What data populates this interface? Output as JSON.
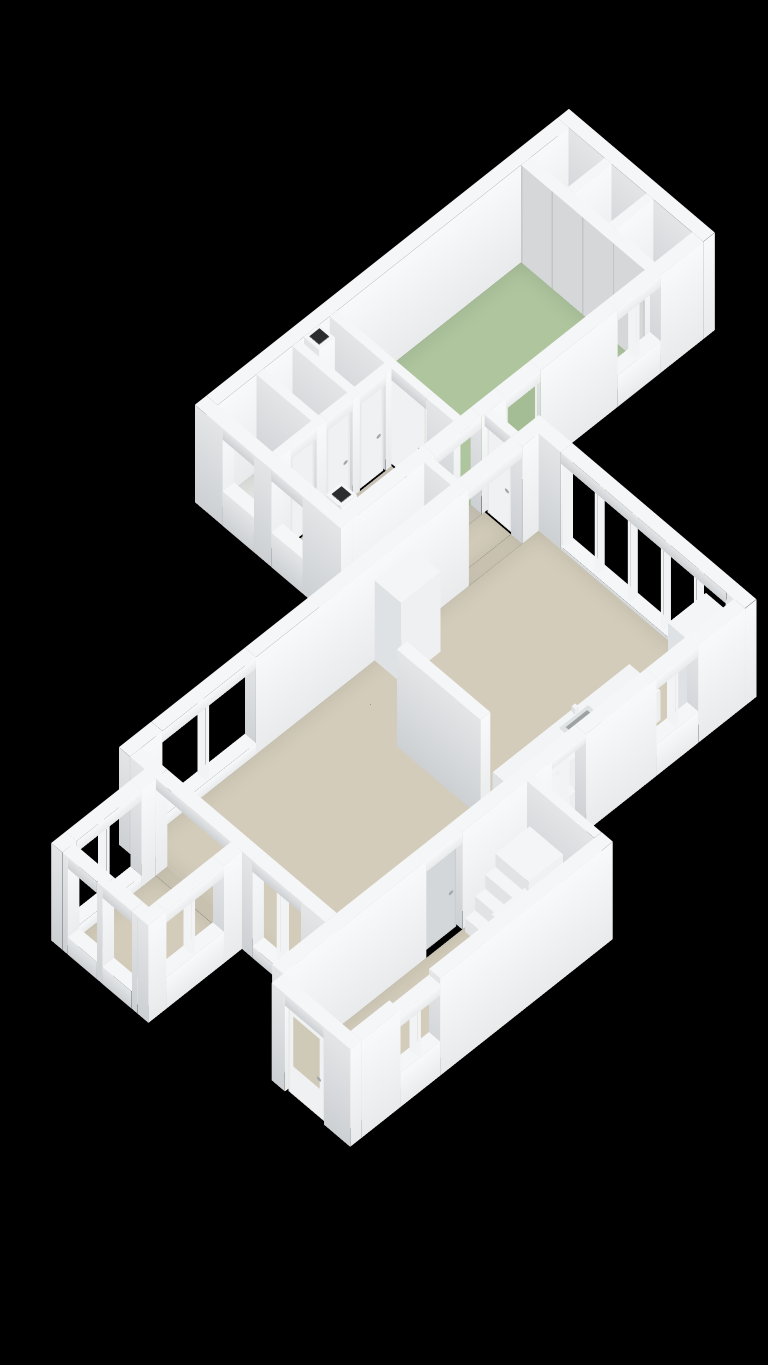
{
  "view": {
    "label": "3D floor plan",
    "background": "#000000"
  },
  "colors": {
    "background": "#000000",
    "wall_top": "#f5f6f8",
    "wall_light": "#f8f9fb",
    "wall_shade": "#e8eaec",
    "wall_side": "#e3e5e7",
    "wall_side_dark": "#cdd0d3",
    "floor_beige": "#d3ccba",
    "floor_green": "#aec59e",
    "floor_light": "#e3e4e2",
    "floor_closet": "#e2e3e5",
    "door_white": "#f0f1f2",
    "door_green": "#a5bd95",
    "door_gray": "#d4d7d9",
    "closet_door": "#d5d7d9",
    "handle": "#a2a7ab",
    "accent_red": "#c0583a",
    "dark": "#222426",
    "sink_basin": "#9ea2a5",
    "glass_seethrough": "#cfc9b8"
  },
  "rooms": [
    {
      "name": "bedroom",
      "floor_color": "#aec59e"
    },
    {
      "name": "built-in-closets",
      "floor_color": "#e2e3e5"
    },
    {
      "name": "corridor",
      "floor_color": "#d0cabc"
    },
    {
      "name": "bathroom",
      "floor_color": "#e3e4e2"
    },
    {
      "name": "toilet",
      "floor_color": "#e3e4e2"
    },
    {
      "name": "storage",
      "floor_color": "#e3e4e2"
    },
    {
      "name": "hall",
      "floor_color": "#d3ccba"
    },
    {
      "name": "living-room",
      "floor_color": "#d3ccba"
    },
    {
      "name": "kitchen",
      "floor_color": "#d3ccba"
    },
    {
      "name": "bay-window",
      "floor_color": "#d3ccba"
    },
    {
      "name": "entrance-hall",
      "floor_color": "#d3ccba"
    }
  ],
  "features": [
    "wardrobe-sliding-doors",
    "french-doors-five-panels",
    "kitchen-counter-with-sink",
    "freestanding-partition-wall",
    "tall-cabinet",
    "staircase",
    "front-door-with-glass",
    "green-back-door",
    "radiator-niche",
    "multiple-windows"
  ]
}
